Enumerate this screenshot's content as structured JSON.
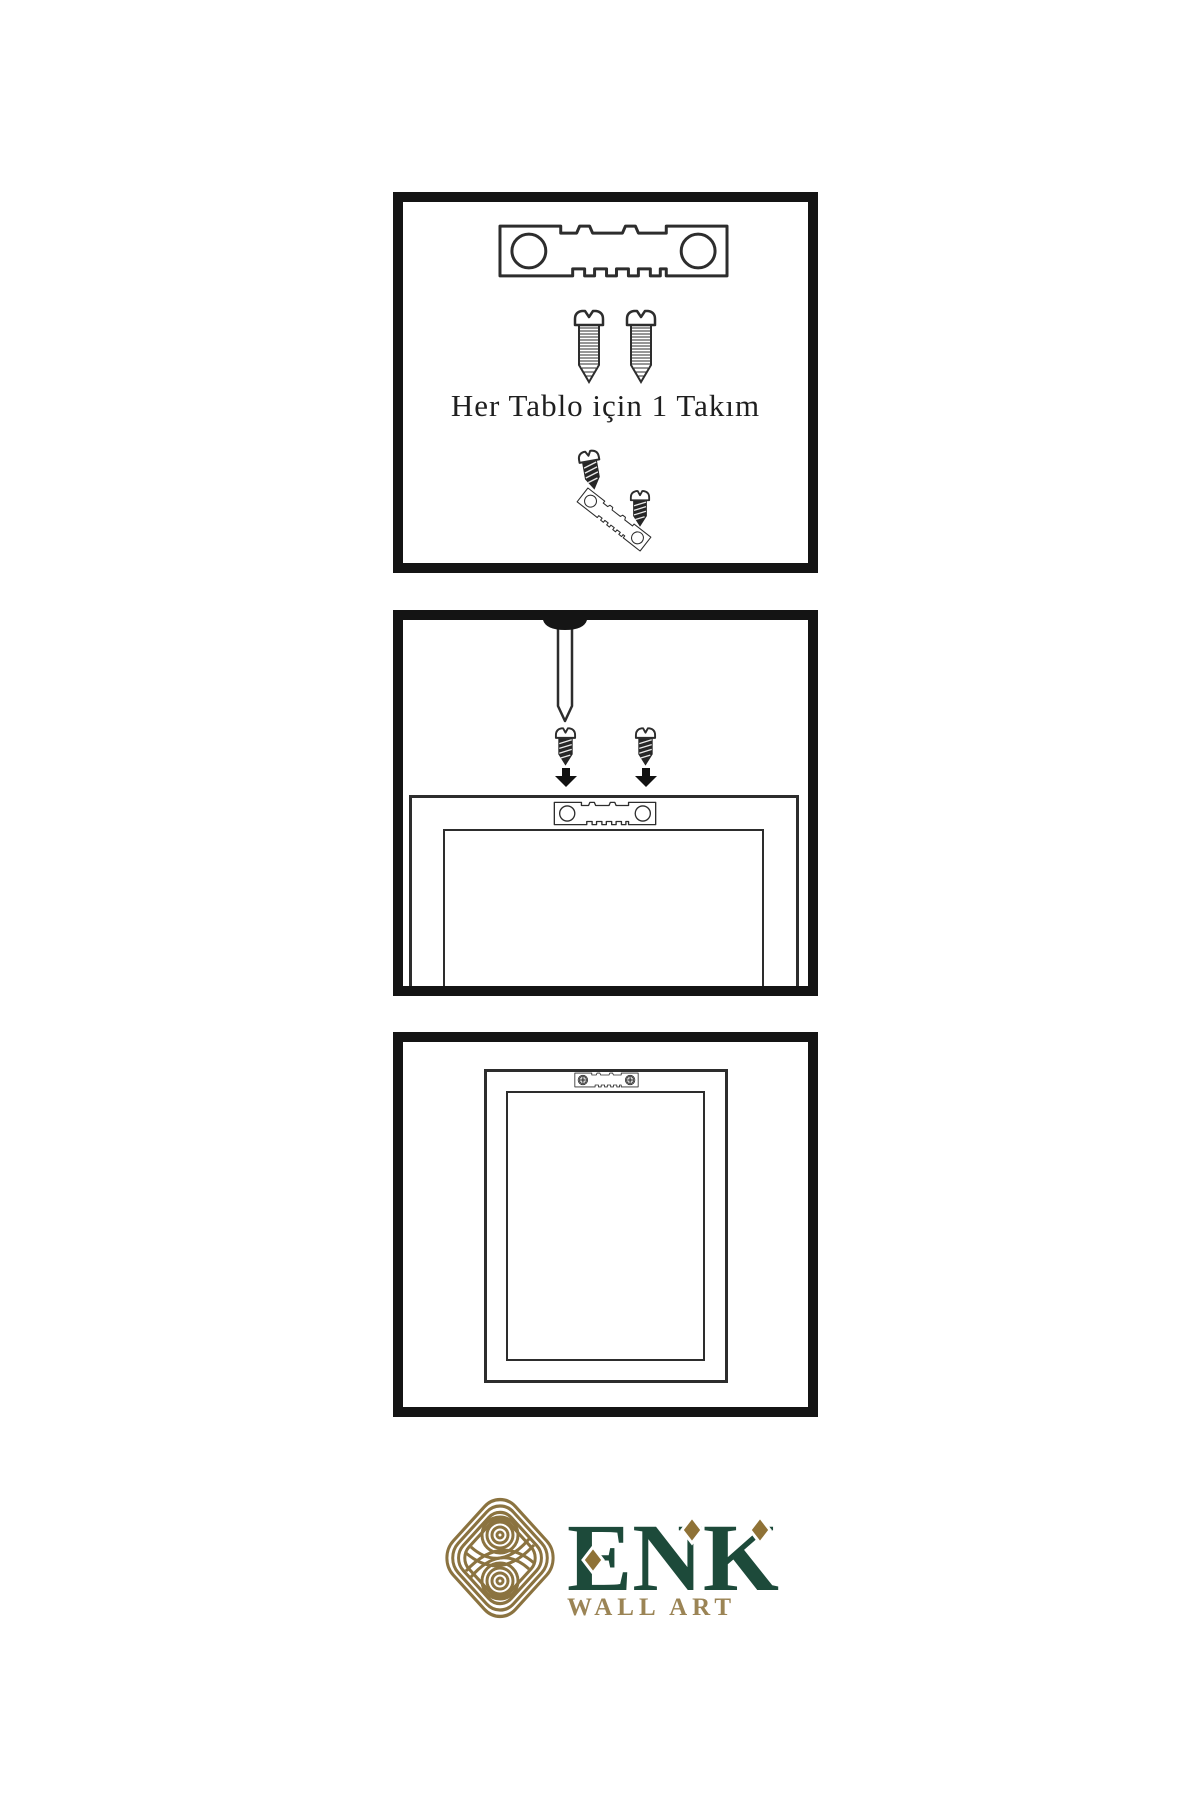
{
  "panels": {
    "kit": {
      "caption": "Her Tablo için 1 Takım",
      "items": [
        "sawtooth-hanger",
        "mounting-screw",
        "mounting-screw",
        "screw-into-hanger-hole",
        "tilted-sawtooth-hanger",
        "mounting-screw"
      ]
    },
    "installation": {
      "items": [
        "wall-nail",
        "mounting-screw",
        "mounting-screw",
        "down-arrow",
        "down-arrow",
        "frame-back-with-sawtooth-hanger"
      ]
    },
    "result": {
      "items": [
        "hung-frame-with-screwed-sawtooth-hanger"
      ]
    }
  },
  "logo": {
    "brand": "ENK",
    "tagline": "WALL ART"
  },
  "colors": {
    "panel_border": "#141414",
    "line_art": "#2d2d2d",
    "brand_green": "#1d4a3a",
    "knot_gold": "#8b7340",
    "diamond_gold": "#8f7236",
    "tagline_gold": "#9b8455"
  }
}
